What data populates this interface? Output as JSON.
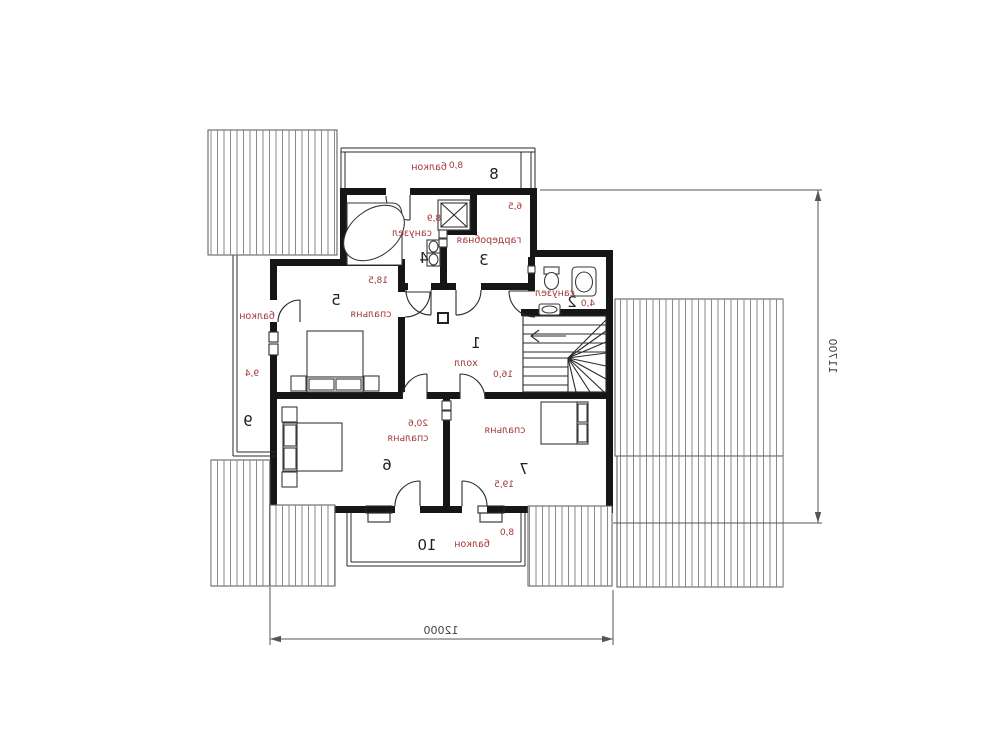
{
  "plan": {
    "type": "second-floor plan, mirrored lettering",
    "rooms": [
      {
        "id": "1",
        "name": "холл",
        "area": "16,0"
      },
      {
        "id": "2",
        "name": "санузел",
        "area": "4,0"
      },
      {
        "id": "3",
        "name": "гардеробная",
        "area": "6,5"
      },
      {
        "id": "4",
        "name": "санузел",
        "area": "8,9"
      },
      {
        "id": "5",
        "name": "спальня",
        "area": "18,5"
      },
      {
        "id": "6",
        "name": "спальня",
        "area": "20,6"
      },
      {
        "id": "7",
        "name": "спальня",
        "area": "19,5"
      },
      {
        "id": "8",
        "name": "балкон",
        "area": "8,0"
      },
      {
        "id": "9",
        "name": "балкон",
        "area": "9,4"
      },
      {
        "id": "10",
        "name": "балкон",
        "area": "8,0"
      }
    ],
    "dimensions": {
      "width_label": "12000",
      "height_label": "11700"
    },
    "colors": {
      "label_red": "#9e3734",
      "wall_black": "#161616",
      "hatch_gray": "#8a8a8a",
      "dim_gray": "#555555"
    }
  }
}
